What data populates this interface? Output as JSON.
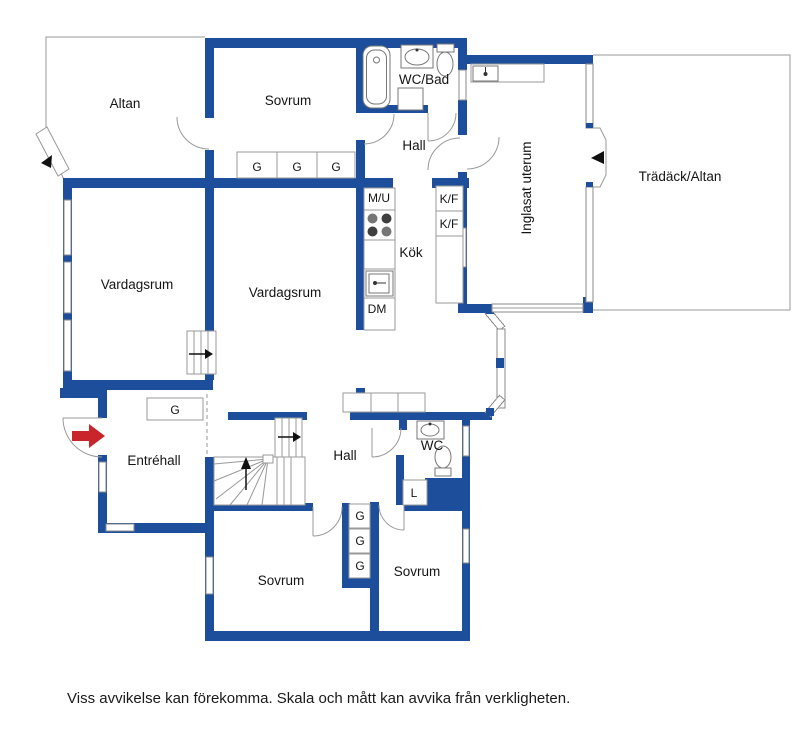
{
  "colors": {
    "wall": "#1d4e9b",
    "entry_arrow": "#c9252b",
    "outline": "#999999"
  },
  "rooms": {
    "altan": "Altan",
    "sovrum_top": "Sovrum",
    "wc_bad": "WC/Bad",
    "hall_upper": "Hall",
    "inglasat_uterum": "Inglasat uterum",
    "tradack_altan": "Trädäck/Altan",
    "kok": "Kök",
    "vardagsrum_west": "Vardagsrum",
    "vardagsrum_center": "Vardagsrum",
    "entrehall": "Entréhall",
    "hall_lower": "Hall",
    "wc": "WC",
    "sovrum_sw": "Sovrum",
    "sovrum_se": "Sovrum"
  },
  "fixtures": {
    "wardrobe_row_top": [
      "G",
      "G",
      "G"
    ],
    "wardrobe_entre": "G",
    "wardrobe_stack": [
      "G",
      "G",
      "G"
    ],
    "linen_closet": "L",
    "micro_oven": "M/U",
    "dishwasher": "DM",
    "fridge_freezer": [
      "K/F",
      "K/F"
    ]
  },
  "footer": {
    "disclaimer": "Viss avvikelse kan förekomma. Skala och mått kan avvika från verkligheten."
  }
}
